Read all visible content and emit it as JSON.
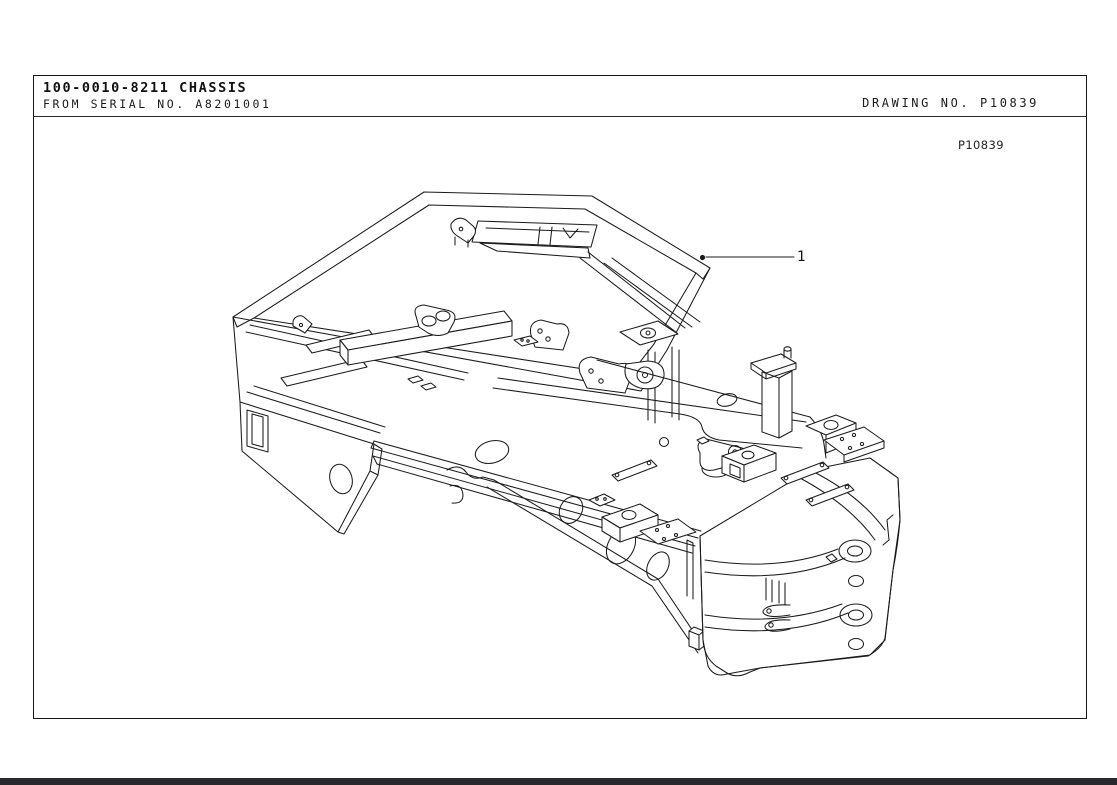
{
  "header": {
    "part_number_title": "100-0010-8211 CHASSIS",
    "serial_line": "FROM SERIAL NO. A8201001",
    "drawing_number": "DRAWING NO. P10839"
  },
  "drawing": {
    "reference_code": "P10839",
    "subject": "chassis isometric line drawing",
    "callouts": [
      {
        "number": "1",
        "points_to": "chassis frame upper rail corner"
      }
    ]
  },
  "colors": {
    "paper": "#ffffff",
    "line_art": "#1b1b1b",
    "sheet_border": "#141414",
    "footer_bar": "#28282b"
  }
}
